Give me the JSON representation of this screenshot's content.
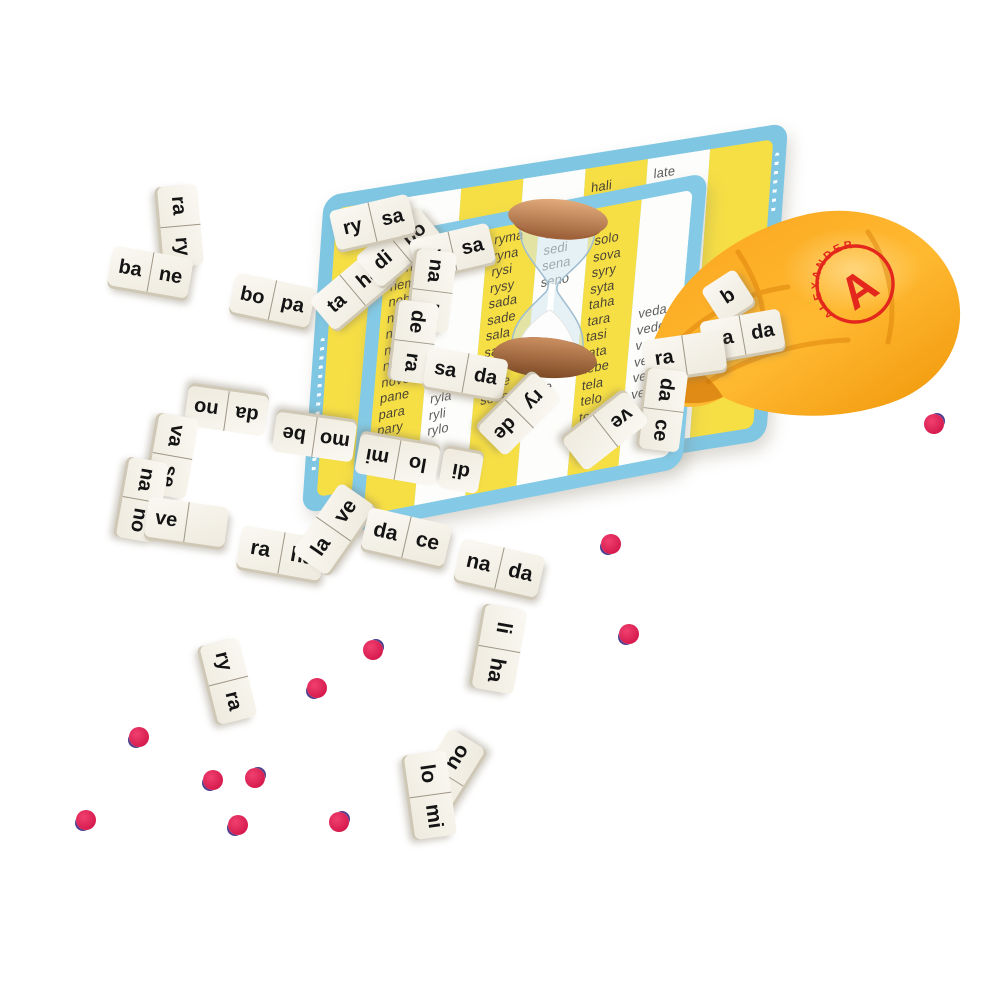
{
  "brand": {
    "name": "ALEXANDER",
    "monogram": "A"
  },
  "back_board": {
    "columns": [
      {
        "words": []
      },
      {
        "words": []
      },
      {
        "words": []
      },
      {
        "words": []
      },
      {
        "words": [
          "hali",
          "halo",
          "hana",
          "hasi"
        ]
      },
      {
        "words": [
          "late",
          "lava",
          "lice",
          "lige"
        ]
      },
      {
        "words": []
      }
    ]
  },
  "front_board": {
    "columns": [
      {
        "words": [
          "neha",
          "nemi",
          "noha",
          "nora",
          "nosy",
          "nota",
          "nova",
          "nove",
          "pane",
          "para",
          "pary"
        ]
      },
      {
        "words": [
          "ryla",
          "ryli",
          "rylo"
        ]
      },
      {
        "words": [
          "ryma",
          "ryna",
          "rysi",
          "rysy",
          "sada",
          "sade",
          "sala",
          "sama",
          "sami",
          "sebe",
          "seda"
        ]
      },
      {
        "words": [
          "sede",
          "sedi",
          "sena",
          "seno"
        ],
        "words2": [
          "sita",
          "site"
        ]
      },
      {
        "words": [
          "solo",
          "sova",
          "syry",
          "syta",
          "taha",
          "tara",
          "tasi",
          "tata",
          "tebe",
          "tela",
          "telo",
          "tema",
          "teta"
        ]
      },
      {
        "words": [
          "veda",
          "vede",
          "vena",
          "veno",
          "veta",
          "veli"
        ]
      }
    ]
  },
  "dominoes": [
    {
      "h": [
        "ra",
        "ry"
      ]
    },
    {
      "h": [
        "ba",
        "ne"
      ]
    },
    {
      "h": [
        "bo",
        "pa"
      ]
    },
    {
      "h": [
        "ta",
        "ha"
      ]
    },
    {
      "h": [
        "di",
        "bo"
      ]
    },
    {
      "h": [
        "ry",
        "sa"
      ]
    },
    {
      "h": [
        "ry",
        "sa"
      ]
    },
    {
      "h": [
        "na",
        "lo"
      ]
    },
    {
      "h": [
        "de",
        "ra"
      ]
    },
    {
      "h": [
        "sa",
        "da"
      ]
    },
    {
      "h": [
        "ry",
        "de"
      ]
    },
    {
      "h": [
        "di"
      ]
    },
    {
      "h": [
        "lo",
        "mi"
      ]
    },
    {
      "h": [
        "mo",
        "be"
      ]
    },
    {
      "h": [
        "da",
        "no"
      ]
    },
    {
      "h": [
        "va",
        "se"
      ]
    },
    {
      "h": [
        "na",
        "no"
      ]
    },
    {
      "h": [
        "ve",
        ""
      ]
    },
    {
      "h": [
        "ra",
        "ha"
      ]
    },
    {
      "h": [
        "la",
        "ve"
      ]
    },
    {
      "h": [
        "da",
        "ce"
      ]
    },
    {
      "h": [
        "na",
        "da"
      ]
    },
    {
      "h": [
        "li",
        "ha"
      ]
    },
    {
      "h": [
        "ry",
        "ra"
      ]
    },
    {
      "h": [
        "",
        "no"
      ]
    },
    {
      "h": [
        "lo",
        "mi"
      ]
    },
    {
      "h": [
        "b"
      ]
    },
    {
      "h": [
        "sa",
        "da"
      ]
    },
    {
      "h": [
        "ra",
        ""
      ]
    },
    {
      "h": [
        "da",
        "ce"
      ]
    },
    {
      "h": [
        "ve",
        ""
      ]
    }
  ]
}
